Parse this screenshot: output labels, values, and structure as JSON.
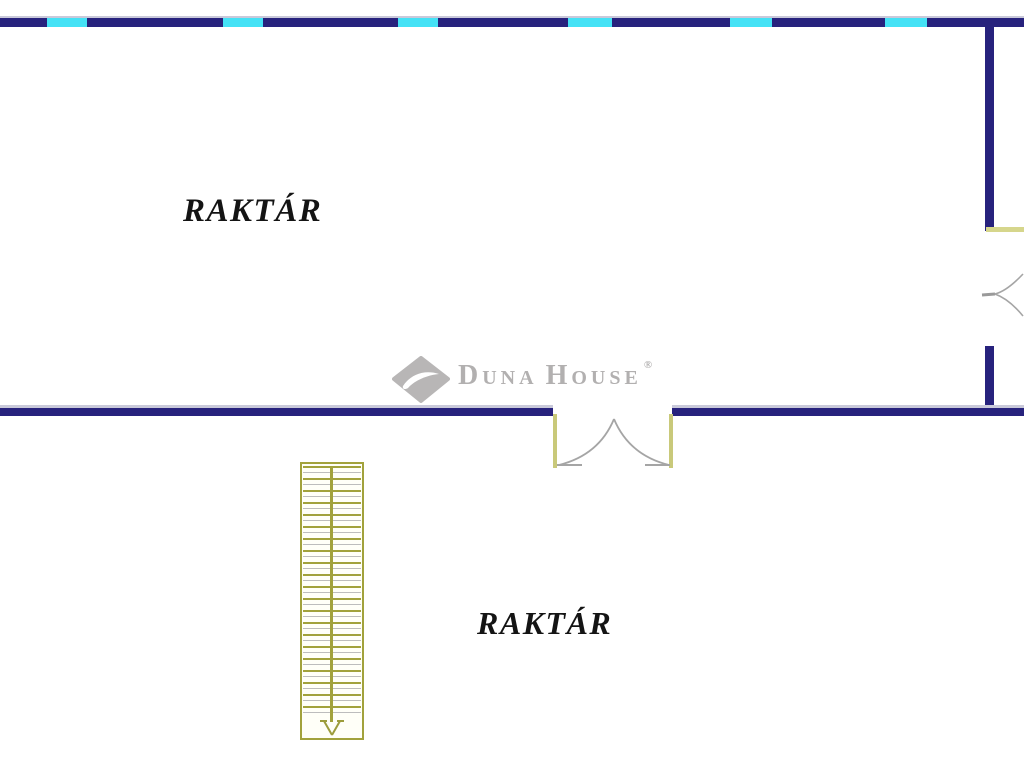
{
  "floorplan": {
    "background": "#ffffff",
    "rooms": [
      {
        "label": "RAKTÁR"
      },
      {
        "label": "RAKTÁR"
      }
    ],
    "watermark": {
      "part_d": "D",
      "part_una": "UNA",
      "part_h": "H",
      "part_ouse": "OUSE",
      "registered": "®",
      "full_name": "DUNA HOUSE®"
    },
    "colors": {
      "wall_navy": "#27227d",
      "window_cyan": "#45e2f6",
      "frame_yellow": "#c9c97a",
      "stairs_olive": "#a2a23c",
      "door_swing_gray": "#a5a5a5",
      "label_text": "#141414",
      "watermark_gray": "#b2b0b0"
    },
    "features": {
      "top_wall_windows": 6,
      "stair_treads": 21,
      "double_door_location": "middle wall",
      "side_door_location": "right wall"
    }
  }
}
